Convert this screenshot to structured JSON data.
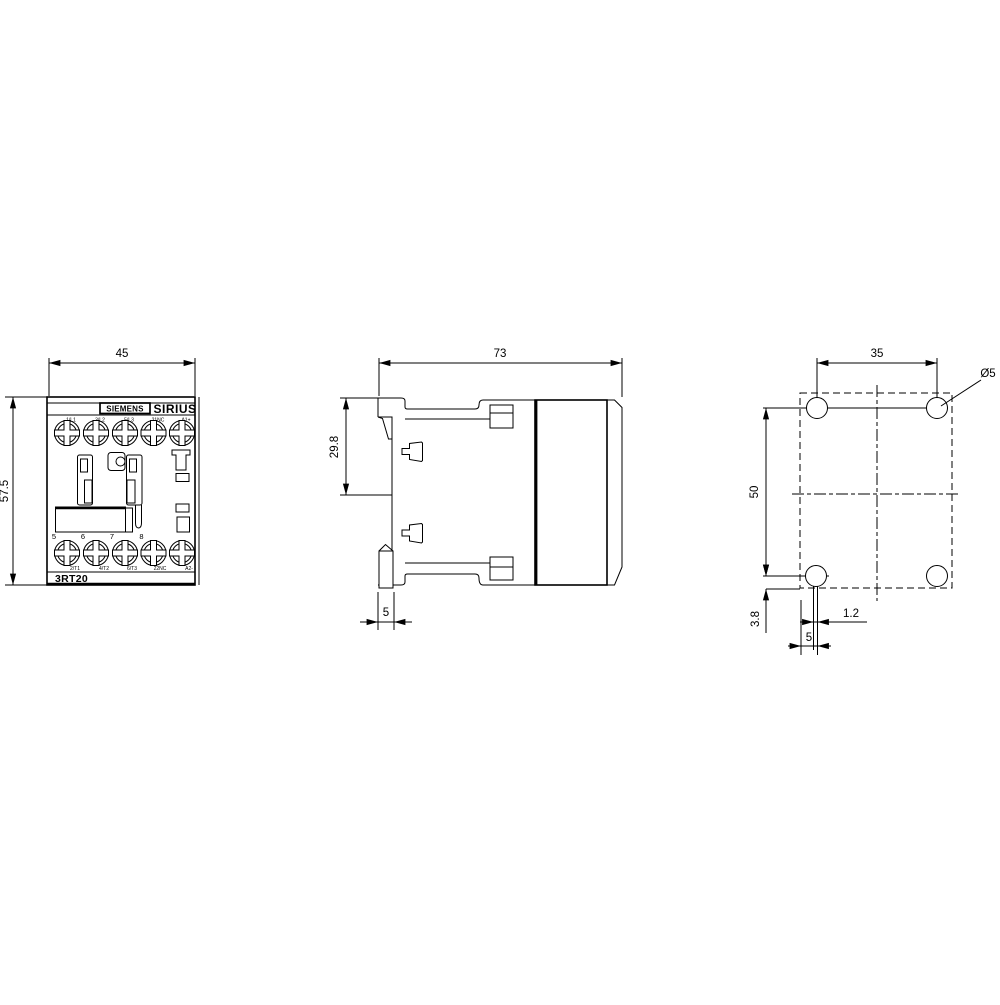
{
  "colors": {
    "line": "#000000",
    "background": "#ffffff"
  },
  "product": {
    "brand": "SIEMENS",
    "series": "SIRIUS",
    "model": "3RT20"
  },
  "front_view": {
    "width_dim": "45",
    "height_dim": "57.5",
    "top_terminals": [
      "1/L1",
      "3/L2",
      "5/L3",
      "21NC",
      "A1+"
    ],
    "bottom_terminal_numbers": [
      "5",
      "6",
      "7",
      "8"
    ],
    "bottom_terminals": [
      "2/T1",
      "4/T2",
      "6/T3",
      "22NC",
      "A2-"
    ]
  },
  "side_view": {
    "depth_dim": "73",
    "rail_offset_dim": "29.8",
    "clip_depth_dim": "5"
  },
  "drill_plan": {
    "hole_spacing_horizontal": "35",
    "hole_spacing_vertical": "50",
    "hole_diameter": "Ø5",
    "bottom_edge_offset": "3.8",
    "slot_width": "1.2",
    "slot_center_offset": "5"
  }
}
